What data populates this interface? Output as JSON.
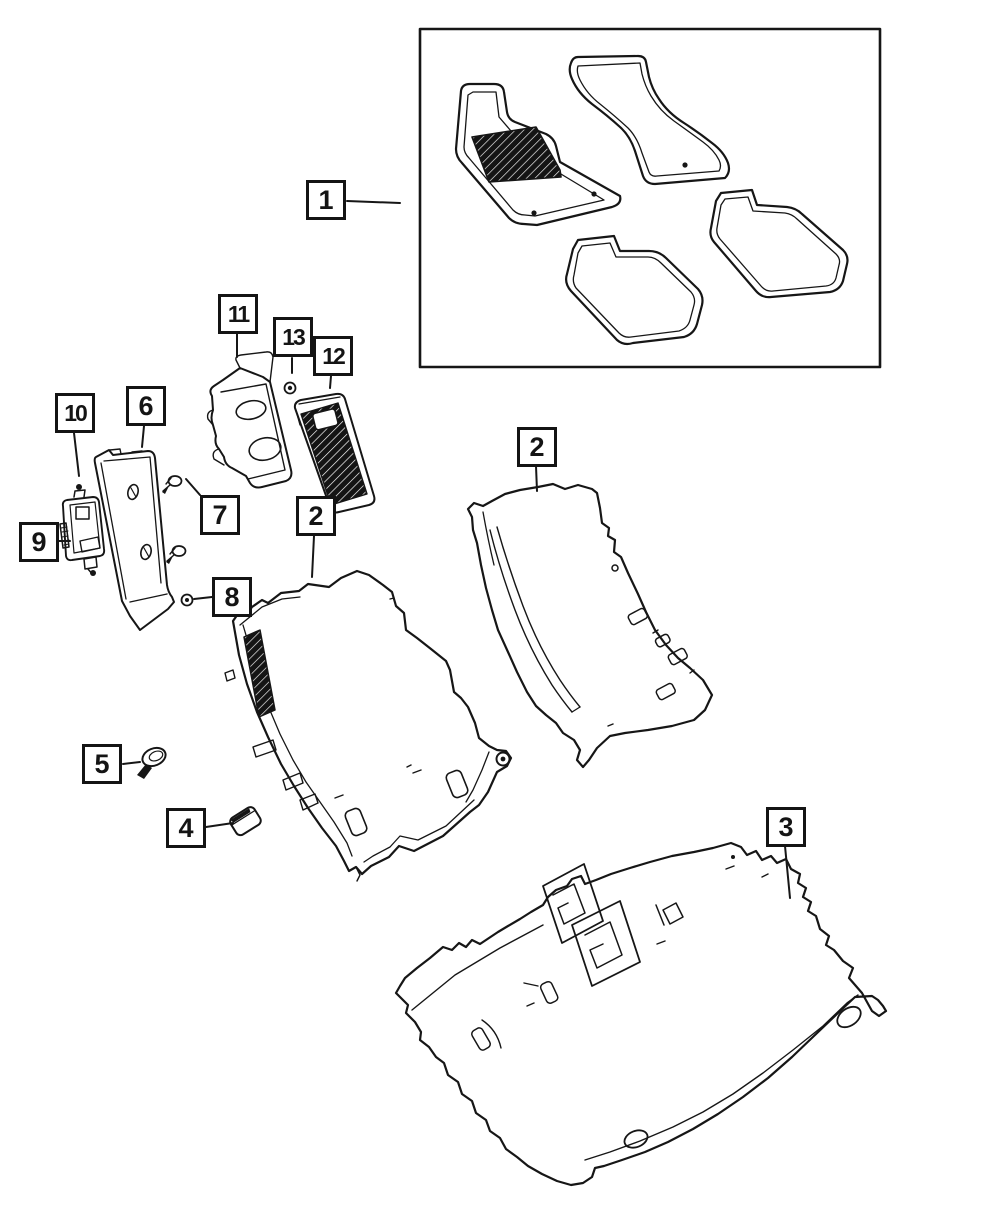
{
  "colors": {
    "line": "#161616",
    "background": "#ffffff",
    "pad_fill": "#141414"
  },
  "callouts": {
    "c1": {
      "label": "1"
    },
    "c2_right": {
      "label": "2"
    },
    "c2_left": {
      "label": "2"
    },
    "c3": {
      "label": "3"
    },
    "c4": {
      "label": "4"
    },
    "c5": {
      "label": "5"
    },
    "c6": {
      "label": "6"
    },
    "c7": {
      "label": "7"
    },
    "c8": {
      "label": "8"
    },
    "c9": {
      "label": "9"
    },
    "c10": {
      "label": "10"
    },
    "c11": {
      "label": "11"
    },
    "c12": {
      "label": "12"
    },
    "c13": {
      "label": "13"
    }
  }
}
